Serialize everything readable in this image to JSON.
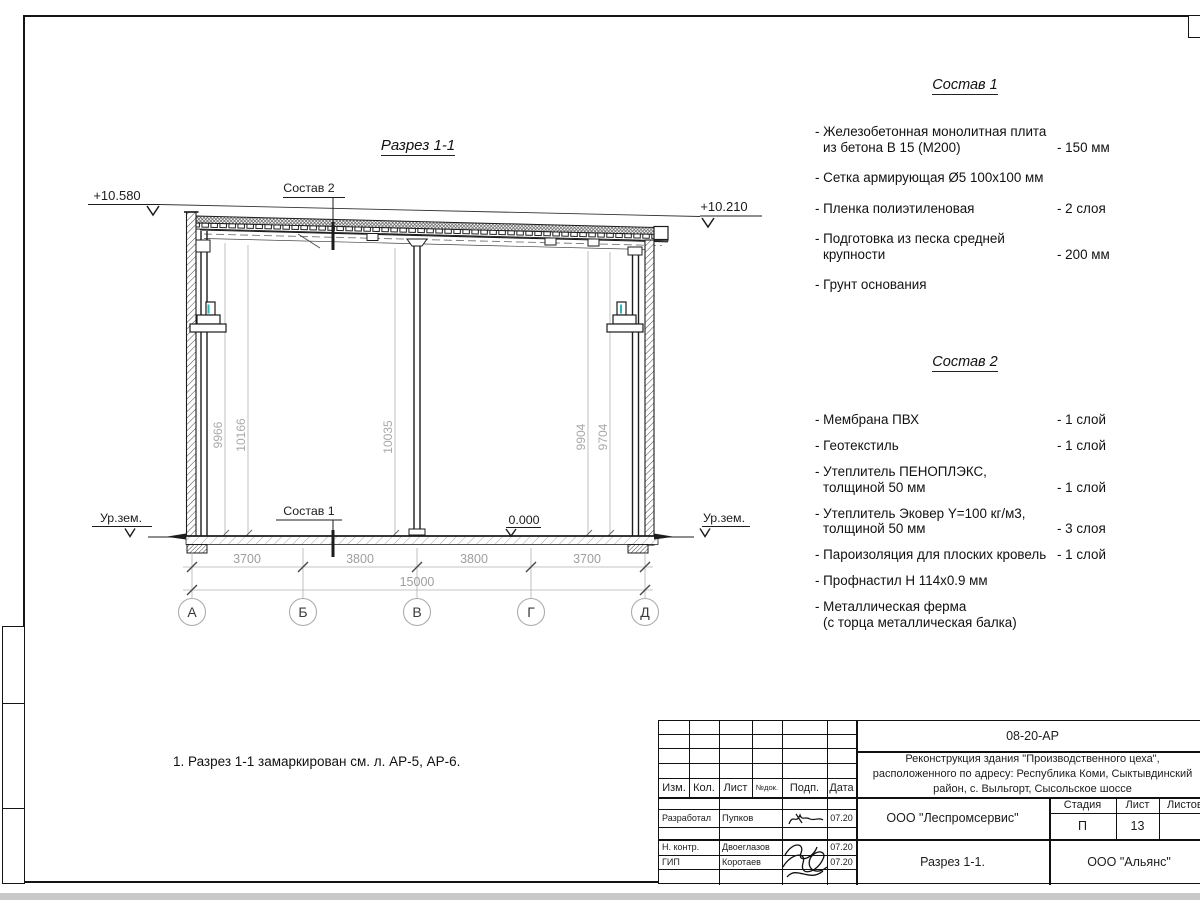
{
  "sheet": {
    "note": "1. Разрез 1-1 замаркирован см. л. АР-5, АР-6."
  },
  "drawing": {
    "title": "Разрез 1-1",
    "elev_left": "+10.580",
    "elev_right": "+10.210",
    "zero_level": "0.000",
    "ground_level_left": "Ур.зем.",
    "ground_level_right": "Ур.зем.",
    "leader_top": "Состав 2",
    "leader_bottom": "Состав 1",
    "axis_labels": [
      "А",
      "Б",
      "В",
      "Г",
      "Д"
    ],
    "dims_span": [
      "3700",
      "3800",
      "3800",
      "3700"
    ],
    "dim_total": "15000",
    "dims_height": [
      "9966",
      "10166",
      "10035",
      "9904",
      "9704"
    ]
  },
  "sostav1": {
    "heading": "Состав 1",
    "items": [
      {
        "line1": "- Железобетонная  монолитная плита",
        "line2": "из бетона В 15 (М200)",
        "value": "- 150 мм"
      },
      {
        "line1": "- Сетка армирующая Ø5 100х100 мм",
        "line2": "",
        "value": ""
      },
      {
        "line1": "- Пленка полиэтиленовая",
        "line2": "",
        "value": "-  2 слоя"
      },
      {
        "line1": "- Подготовка из песка средней",
        "line2": "крупности",
        "value": "- 200 мм"
      },
      {
        "line1": "- Грунт основания",
        "line2": "",
        "value": ""
      }
    ]
  },
  "sostav2": {
    "heading": "Состав 2",
    "items": [
      {
        "line1": "- Мембрана ПВХ",
        "line2": "",
        "value": "- 1 слой"
      },
      {
        "line1": "- Геотекстиль",
        "line2": "",
        "value": "- 1 слой"
      },
      {
        "line1": "- Утеплитель ПЕНОПЛЭКС,",
        "line2": "толщиной 50 мм",
        "value": "- 1 слой"
      },
      {
        "line1": "- Утеплитель Эковер Y=100 кг/м3,",
        "line2": "толщиной 50 мм",
        "value": "- 3 слоя"
      },
      {
        "line1": "- Пароизоляция для плоских кровель",
        "line2": "",
        "value": "- 1 слой"
      },
      {
        "line1": "- Профнастил Н 114х0.9 мм",
        "line2": "",
        "value": ""
      },
      {
        "line1": "- Металлическая ферма",
        "line2": "(с торца металлическая балка)",
        "value": ""
      }
    ]
  },
  "titleblock": {
    "doc_number": "08-20-АР",
    "project_line1": "Реконструкция здания \"Производственного цеха\",",
    "project_line2": "расположенного по адресу: Республика Коми, Сыктывдинский",
    "project_line3": "район, с. Выльгорт, Сысольское шоссе",
    "designer_org": "ООО \"Леспромсервис\"",
    "sheet_name": "Разрез 1-1.",
    "client_org": "ООО \"Альянс\"",
    "stage_label": "Стадия",
    "list_label": "Лист",
    "listov_label": "Листов",
    "stage_value": "П",
    "list_value": "13",
    "col_headers": {
      "izm": "Изм.",
      "kol": "Кол.",
      "list": "Лист",
      "ndok": "№док.",
      "podp": "Подп.",
      "data": "Дата"
    },
    "rows": [
      {
        "role": "Разработал",
        "name": "Пупков",
        "date": "07.20"
      },
      {
        "role": "Н. контр.",
        "name": "Двоеглазов",
        "date": "07.20"
      },
      {
        "role": "ГИП",
        "name": "Коротаев",
        "date": "07.20"
      }
    ]
  },
  "colors": {
    "line": "#1c1c1c",
    "dim_gray": "#9e9e9e",
    "accent_teal": "#2cb5b5"
  }
}
